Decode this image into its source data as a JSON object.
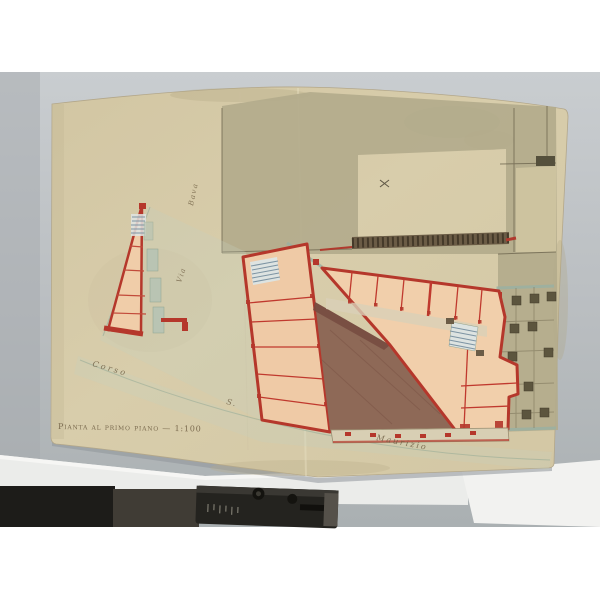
{
  "plan": {
    "caption": "Pianta al primo piano — 1:100",
    "streets": {
      "vertical_street_name": "Bava",
      "vertical_street_prefix": "Via",
      "corso_word": "Corso",
      "santo_abbrev": "S.",
      "maurizio_word": "Maurizio"
    }
  },
  "colors": {
    "paper": "#d6cbaa",
    "olive_wash": "#b3ab8c",
    "wall_red": "#b5372b",
    "room_pink": "#f0cda9",
    "courtyard_brown": "#8e6957",
    "stair_teal": "#7d94a3",
    "sidewalk_teal": "#9ab0a2",
    "ink_sepia": "#6b5a3f",
    "backdrop_grey": "#b7bbbe",
    "sheet_white": "#eceded",
    "device_black": "#24231f"
  }
}
